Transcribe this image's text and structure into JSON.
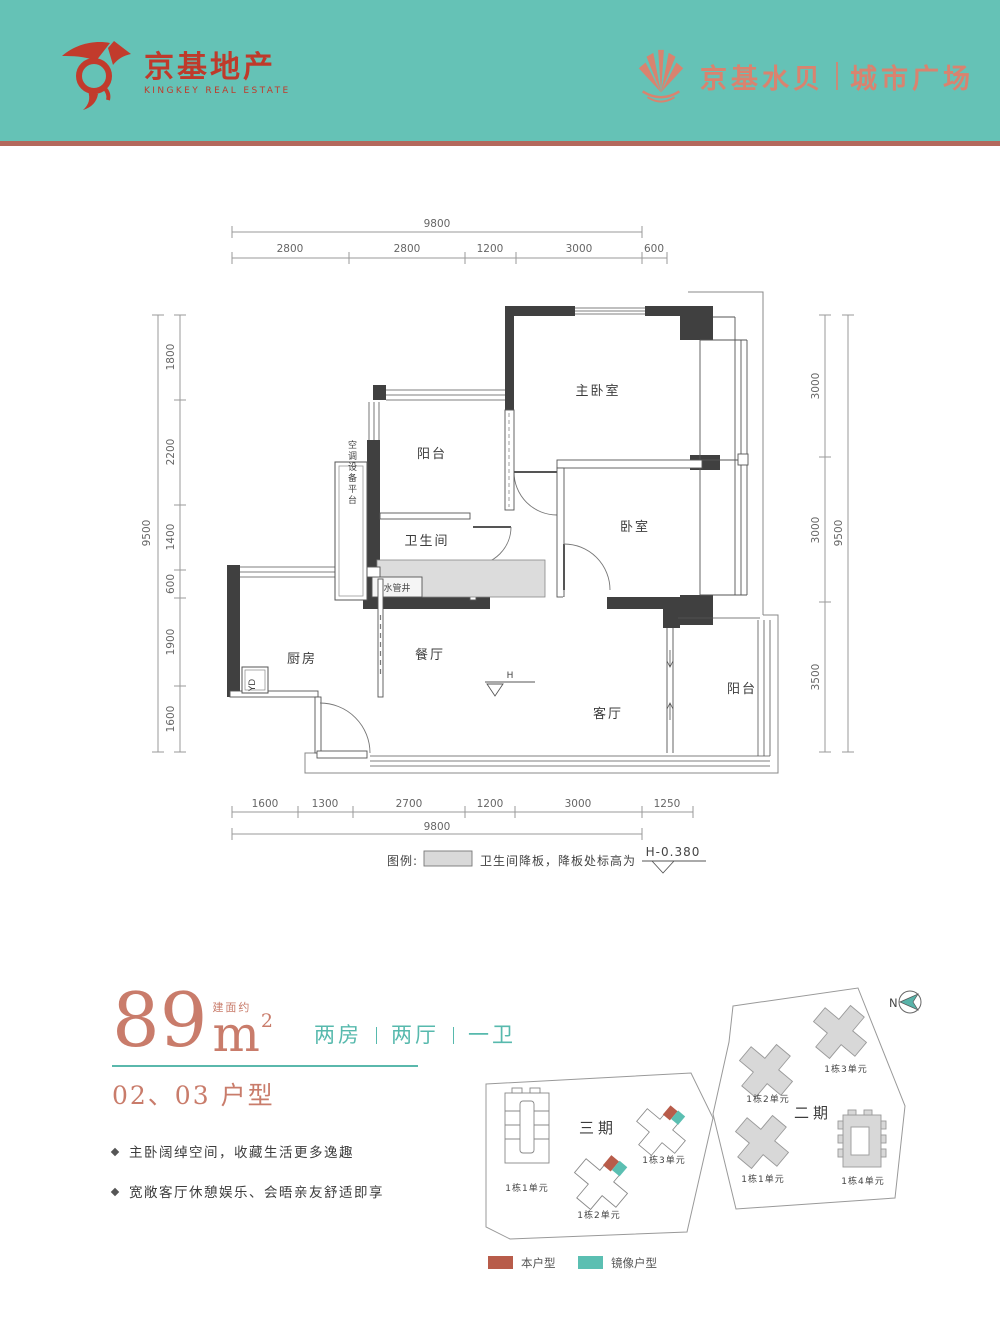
{
  "header": {
    "brand_left_cn": "京基地产",
    "brand_left_en": "KINGKEY REAL ESTATE",
    "brand_right_cn": "京基水贝",
    "brand_right_suffix": "城市广场"
  },
  "floorplan": {
    "dims_top": {
      "total": "9800",
      "segments": [
        "2800",
        "2800",
        "1200",
        "3000",
        "600"
      ]
    },
    "dims_bottom": {
      "total": "9800",
      "segments": [
        "1600",
        "1300",
        "2700",
        "1200",
        "3000",
        "1250"
      ]
    },
    "dims_left": {
      "total": "9500",
      "segments": [
        "1800",
        "2200",
        "1400",
        "600",
        "1900",
        "1600"
      ]
    },
    "dims_right": {
      "total": "9500",
      "segments": [
        "3000",
        "3000",
        "3500"
      ]
    },
    "rooms": {
      "master_bedroom": "主卧室",
      "balcony_top": "阳台",
      "bathroom": "卫生间",
      "bedroom": "卧室",
      "kitchen": "厨房",
      "dining": "餐厅",
      "living": "客厅",
      "balcony_right": "阳台",
      "pipe_shaft": "水管井",
      "ac_platform": "空调设备平台",
      "yd": "YD",
      "h_marker": "H"
    },
    "legend_prefix": "图例:",
    "legend_text": "卫生间降板，降板处标高为",
    "legend_value": "H-0.380"
  },
  "info": {
    "area_value": "89",
    "area_unit": "m",
    "area_exp": "2",
    "area_note": "建面约",
    "layout_parts": [
      "两房",
      "两厅",
      "一卫"
    ],
    "unit_title": "02、03 户型",
    "bullets": [
      "主卧阔绰空间，收藏生活更多逸趣",
      "宽敞客厅休憩娱乐、会晤亲友舒适即享"
    ]
  },
  "siteplan": {
    "phase3_label": "三期",
    "phase2_label": "二期",
    "p3_b1": "1栋1单元",
    "p3_b2": "1栋2单元",
    "p3_b3": "1栋3单元",
    "p2_b1": "1栋1单元",
    "p2_b2": "1栋2单元",
    "p2_b3": "1栋3单元",
    "p2_b4": "1栋4单元",
    "compass": "N",
    "legend_self": "本户型",
    "legend_mirror": "镜像户型"
  },
  "icons": {
    "kingkey_logo": "bull-crest-icon",
    "fan_logo": "fan-icon",
    "compass": "compass-arrow-icon"
  },
  "colors": {
    "header_teal": "#65c2b6",
    "header_divider": "#b3685c",
    "brand_red": "#bf3a2b",
    "brand_salmon": "#d9836f",
    "accent_teal": "#5ab8ac",
    "accent_salmon": "#c97c6b",
    "legend_self_red": "#b85c4a",
    "legend_mirror_teal": "#5bbfb2",
    "wall_dark": "#404040",
    "slab_gray": "#dcdcdc"
  }
}
